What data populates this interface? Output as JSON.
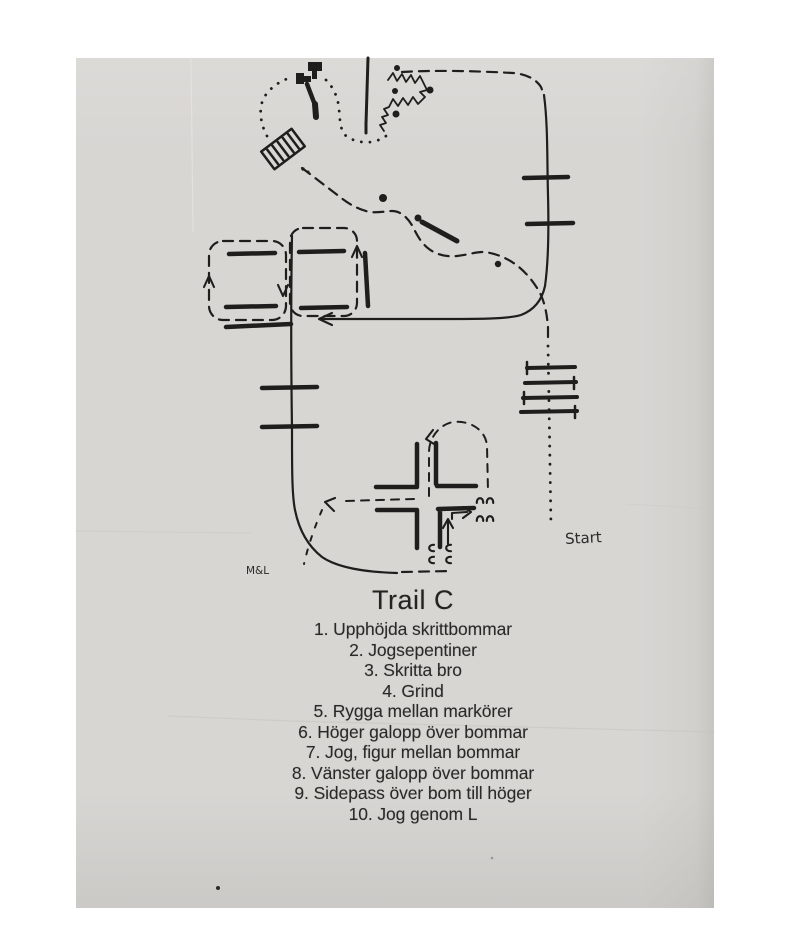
{
  "colors": {
    "ink": "#1f1e1c",
    "paper": "#d8d6d3",
    "page_bg": "#ffffff"
  },
  "labels": {
    "start": "Start",
    "initials": "M&L"
  },
  "course": {
    "title": "Trail C",
    "items": [
      "1. Upphöjda skrittbommar",
      "2. Jogsepentiner",
      "3. Skritta bro",
      "4. Grind",
      "5. Rygga mellan markörer",
      "6. Höger galopp över bommar",
      "7. Jog, figur mellan bommar",
      "8. Vänster galopp över bommar",
      "9. Sidepass över bom till höger",
      "10. Jog genom L"
    ]
  }
}
